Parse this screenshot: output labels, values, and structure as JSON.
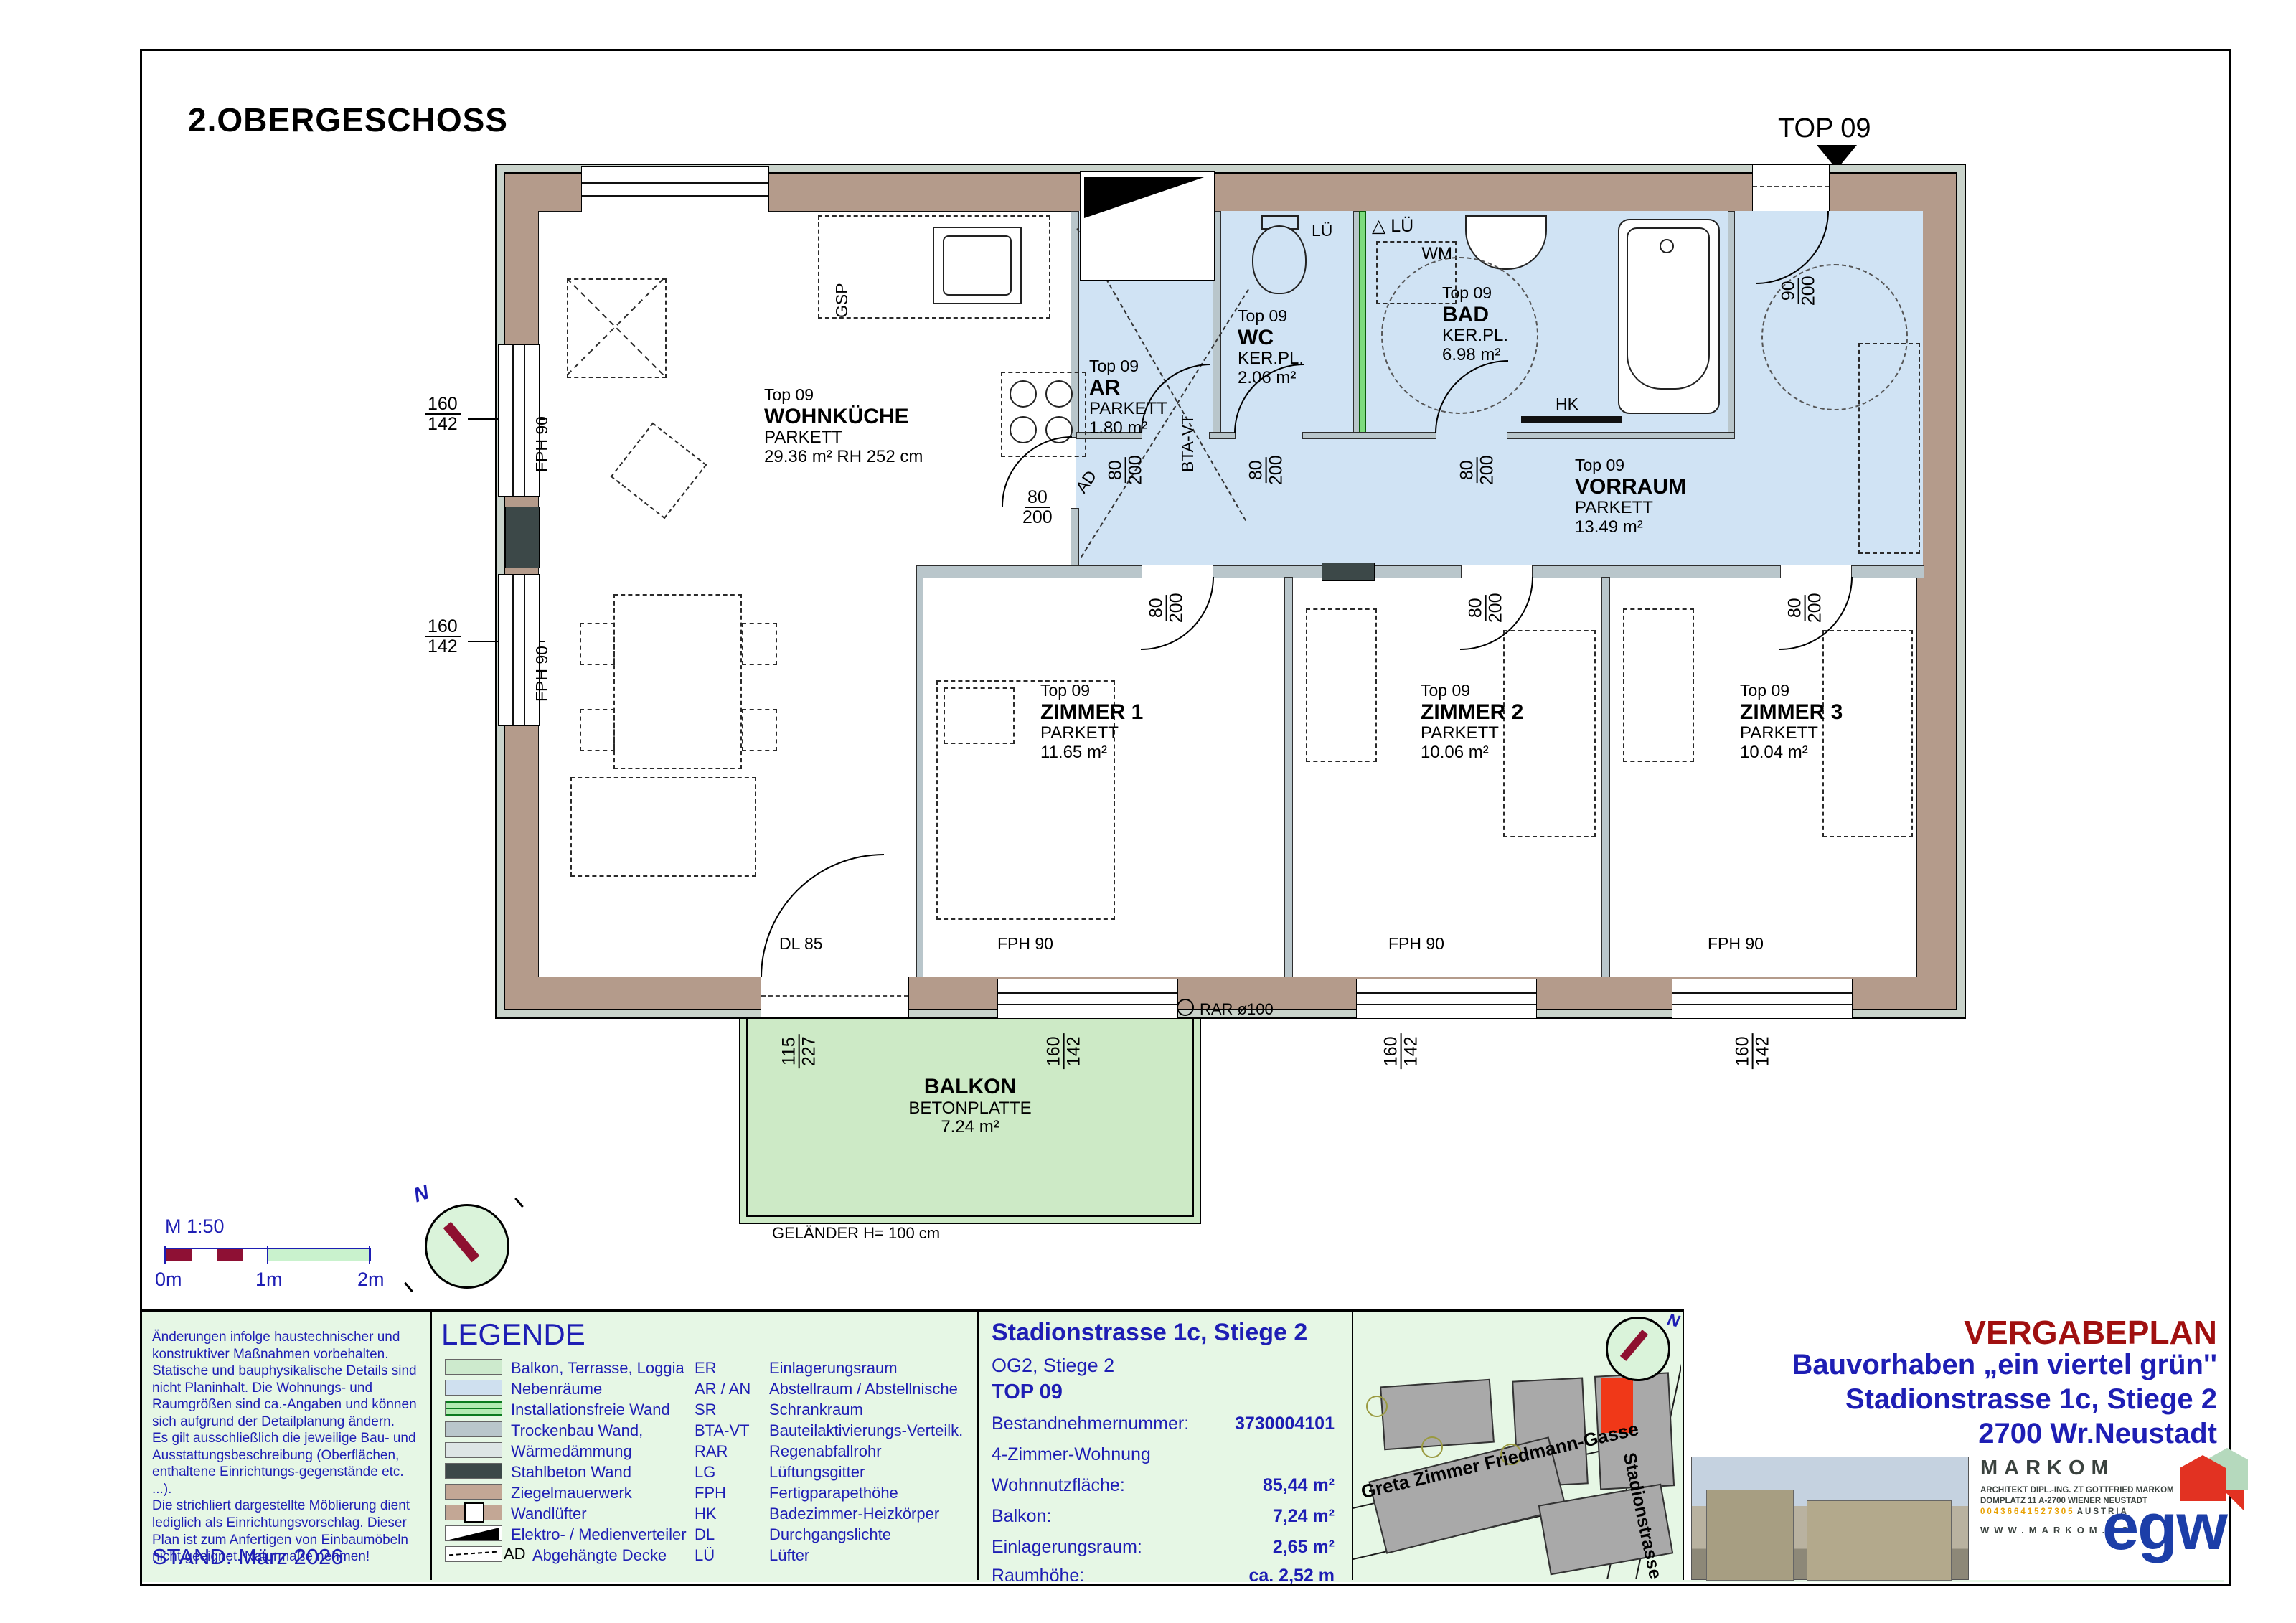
{
  "sheet": {
    "floor_title": "2.OBERGESCHOSS",
    "top_marker": "TOP 09",
    "stand": "STAND: März 2026"
  },
  "scalebar": {
    "label": "M 1:50",
    "t0": "0m",
    "t1": "1m",
    "t2": "2m"
  },
  "compass": {
    "north": "N"
  },
  "rooms": {
    "wohnkueche": {
      "top": "Top 09",
      "name": "WOHNKÜCHE",
      "floor": "PARKETT",
      "area": "29.36 m² RH 252 cm"
    },
    "ar": {
      "top": "Top 09",
      "name": "AR",
      "floor": "PARKETT",
      "area": "1.80 m²"
    },
    "wc": {
      "top": "Top 09",
      "name": "WC",
      "floor": "KER.PL.",
      "area": "2.06 m²"
    },
    "bad": {
      "top": "Top 09",
      "name": "BAD",
      "floor": "KER.PL.",
      "area": "6.98 m²"
    },
    "vorraum": {
      "top": "Top 09",
      "name": "VORRAUM",
      "floor": "PARKETT",
      "area": "13.49 m²"
    },
    "zimmer1": {
      "top": "Top 09",
      "name": "ZIMMER 1",
      "floor": "PARKETT",
      "area": "11.65 m²"
    },
    "zimmer2": {
      "top": "Top 09",
      "name": "ZIMMER 2",
      "floor": "PARKETT",
      "area": "10.06 m²"
    },
    "zimmer3": {
      "top": "Top 09",
      "name": "ZIMMER 3",
      "floor": "PARKETT",
      "area": "10.04 m²"
    },
    "balkon": {
      "name": "BALKON",
      "floor": "BETONPLATTE",
      "area": "7.24 m²"
    }
  },
  "dims": {
    "v160": "160",
    "v142": "142",
    "v80": "80",
    "v200": "200",
    "v90": "90",
    "v115": "115",
    "v227": "227",
    "dl": "DL 85",
    "fph": "FPH 90",
    "rar": "RAR ø100",
    "gelaender": "GELÄNDER H= 100 cm"
  },
  "marks": {
    "gsp": "GSP",
    "wm": "WM",
    "hk": "HK",
    "lue": "LÜ",
    "ad": "AD",
    "btavt": "BTA-VT",
    "triangle": "△"
  },
  "disclaimer": {
    "text": "Änderungen infolge haustechnischer und\nkonstruktiver Maßnahmen vorbehalten.\nStatische und bauphysikalische Details sind\nnicht Planinhalt. Die Wohnungs- und\nRaumgrößen sind ca.-Angaben und können\nsich aufgrund der Detailplanung ändern.\nEs gilt ausschließlich die jeweilige Bau- und\nAusstattungsbeschreibung (Oberflächen,\nenthaltene Einrichtungs-gegenstände etc. ...).\nDie strichliert dargestellte Möblierung dient\nlediglich als Einrichtungsvorschlag. Dieser\nPlan ist zum Anfertigen von Einbaumöbeln\nnicht geeignet. Naturmaße nehmen!"
  },
  "legend": {
    "title": "LEGENDE",
    "ad_tag": "AD",
    "items": [
      {
        "label": "Balkon, Terrasse, Loggia"
      },
      {
        "label": "Nebenräume"
      },
      {
        "label": "Installationsfreie Wand"
      },
      {
        "label": "Trockenbau Wand,"
      },
      {
        "label": "Wärmedämmung"
      },
      {
        "label": "Stahlbeton Wand"
      },
      {
        "label": "Ziegelmauerwerk"
      },
      {
        "label": "Wandlüfter"
      },
      {
        "label": "Elektro- / Medienverteiler"
      },
      {
        "label": "Abgehängte Decke"
      }
    ],
    "abbr": [
      {
        "k": "ER",
        "v": "Einlagerungsraum"
      },
      {
        "k": "AR / AN",
        "v": "Abstellraum / Abstellnische"
      },
      {
        "k": "SR",
        "v": "Schrankraum"
      },
      {
        "k": "BTA-VT",
        "v": "Bauteilaktivierungs-Verteilk."
      },
      {
        "k": "RAR",
        "v": "Regenabfallrohr"
      },
      {
        "k": "LG",
        "v": "Lüftungsgitter"
      },
      {
        "k": "FPH",
        "v": "Fertigparapethöhe"
      },
      {
        "k": "HK",
        "v": "Badezimmer-Heizkörper"
      },
      {
        "k": "DL",
        "v": "Durchgangslichte"
      },
      {
        "k": "LÜ",
        "v": "Lüfter"
      }
    ]
  },
  "info": {
    "address": "Stadionstrasse 1c, Stiege 2",
    "floor": "OG2, Stiege 2",
    "unit": "TOP 09",
    "rows": [
      {
        "label": "Bestandnehmernummer:",
        "value": "3730004101"
      },
      {
        "label": "4-Zimmer-Wohnung",
        "value": ""
      },
      {
        "label": "Wohnnutzfläche:",
        "value": "85,44 m²"
      },
      {
        "label": "Balkon:",
        "value": "7,24 m²"
      },
      {
        "label": "Einlagerungsraum:",
        "value": "2,65 m²"
      },
      {
        "label": "Raumhöhe:",
        "value": "ca. 2,52 m"
      }
    ]
  },
  "siteplan": {
    "street1": "Greta Zimmer Friedmann-Gasse",
    "street2": "Stadionstrasse"
  },
  "titleblock": {
    "plan_type": "VERGABEPLAN",
    "line1": "Bauvorhaben „ein viertel grün''",
    "line2": "Stadionstrasse 1c, Stiege 2",
    "line3": "2700 Wr.Neustadt",
    "architect": {
      "name": "MARKOM",
      "line1": "ARCHITEKT DIPL.-ING. ZT GOTTFRIED MARKOM",
      "line2": "DOMPLATZ 11  A-2700 WIENER NEUSTADT",
      "phone": "00436641527305",
      "country": "AUSTRIA",
      "web": "WWW.MARKOM.CC"
    },
    "logo_text": "egw"
  }
}
